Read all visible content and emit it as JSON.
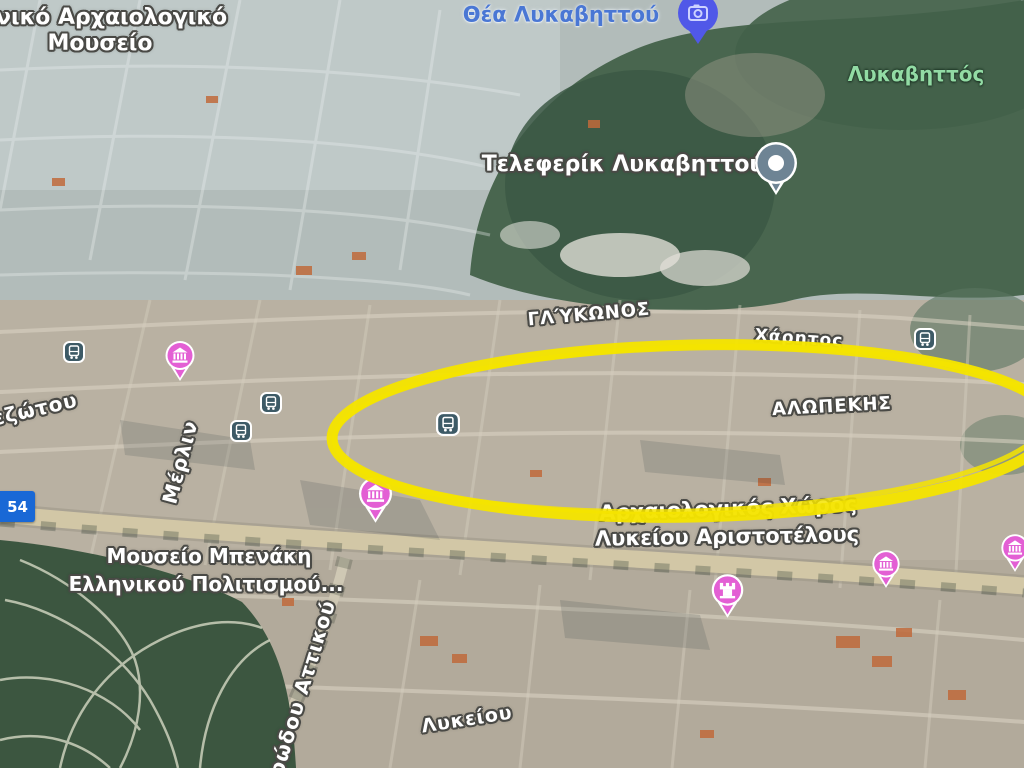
{
  "colors": {
    "highlight": "#F5E400",
    "poi_pink": "#E35FD4",
    "transit_blue": "#3D5A66",
    "route_badge_blue": "#1968D6",
    "label_blue": "#4A77D4",
    "label_green": "#92DBA4",
    "photo_pin_blue": "#5058E8",
    "poi_gray": "#6E8494"
  },
  "labels": {
    "national_museum_line1": "θνικό Αρχαιολογικό",
    "national_museum_line2": "Μουσείο",
    "lycabettus_view": "Θέα Λυκαβηττού",
    "lycabettus_hill": "Λυκαβηττός",
    "funicular": "Τελεφερίκ Λυκαβηττού",
    "benaki_line1": "Μουσείο Μπενάκη",
    "benaki_line2": "Ελληνικού Πολιτισμού...",
    "lyceum_line1": "Αρχαιολογικός Χώρος",
    "lyceum_line2": "Λυκείου Αριστοτέλους",
    "route_badge": "54"
  },
  "streets": {
    "glykonos": "ΓΛΎΚΩΝΟΣ",
    "charitos": "Χάρητος",
    "alopekis": "ΑΛΩΠΕΚΗΣ",
    "ezotou": "εζώτου",
    "merlin": "Μέρλιν",
    "lykeiou": "Λυκείου",
    "irodou_attikou": "ρώδου Αττικού"
  },
  "icons": {
    "photo-spot-pin": "blue pin with camera glyph",
    "poi-dot-pin": "gray teardrop pin with white dot",
    "museum-pin": "pink pin with columned museum glyph",
    "landmark-pin": "pink pin with castle glyph",
    "transit-icon": "dark rounded square with white bus glyph",
    "highlight-ellipse": "hand-drawn yellow ellipse annotation"
  }
}
